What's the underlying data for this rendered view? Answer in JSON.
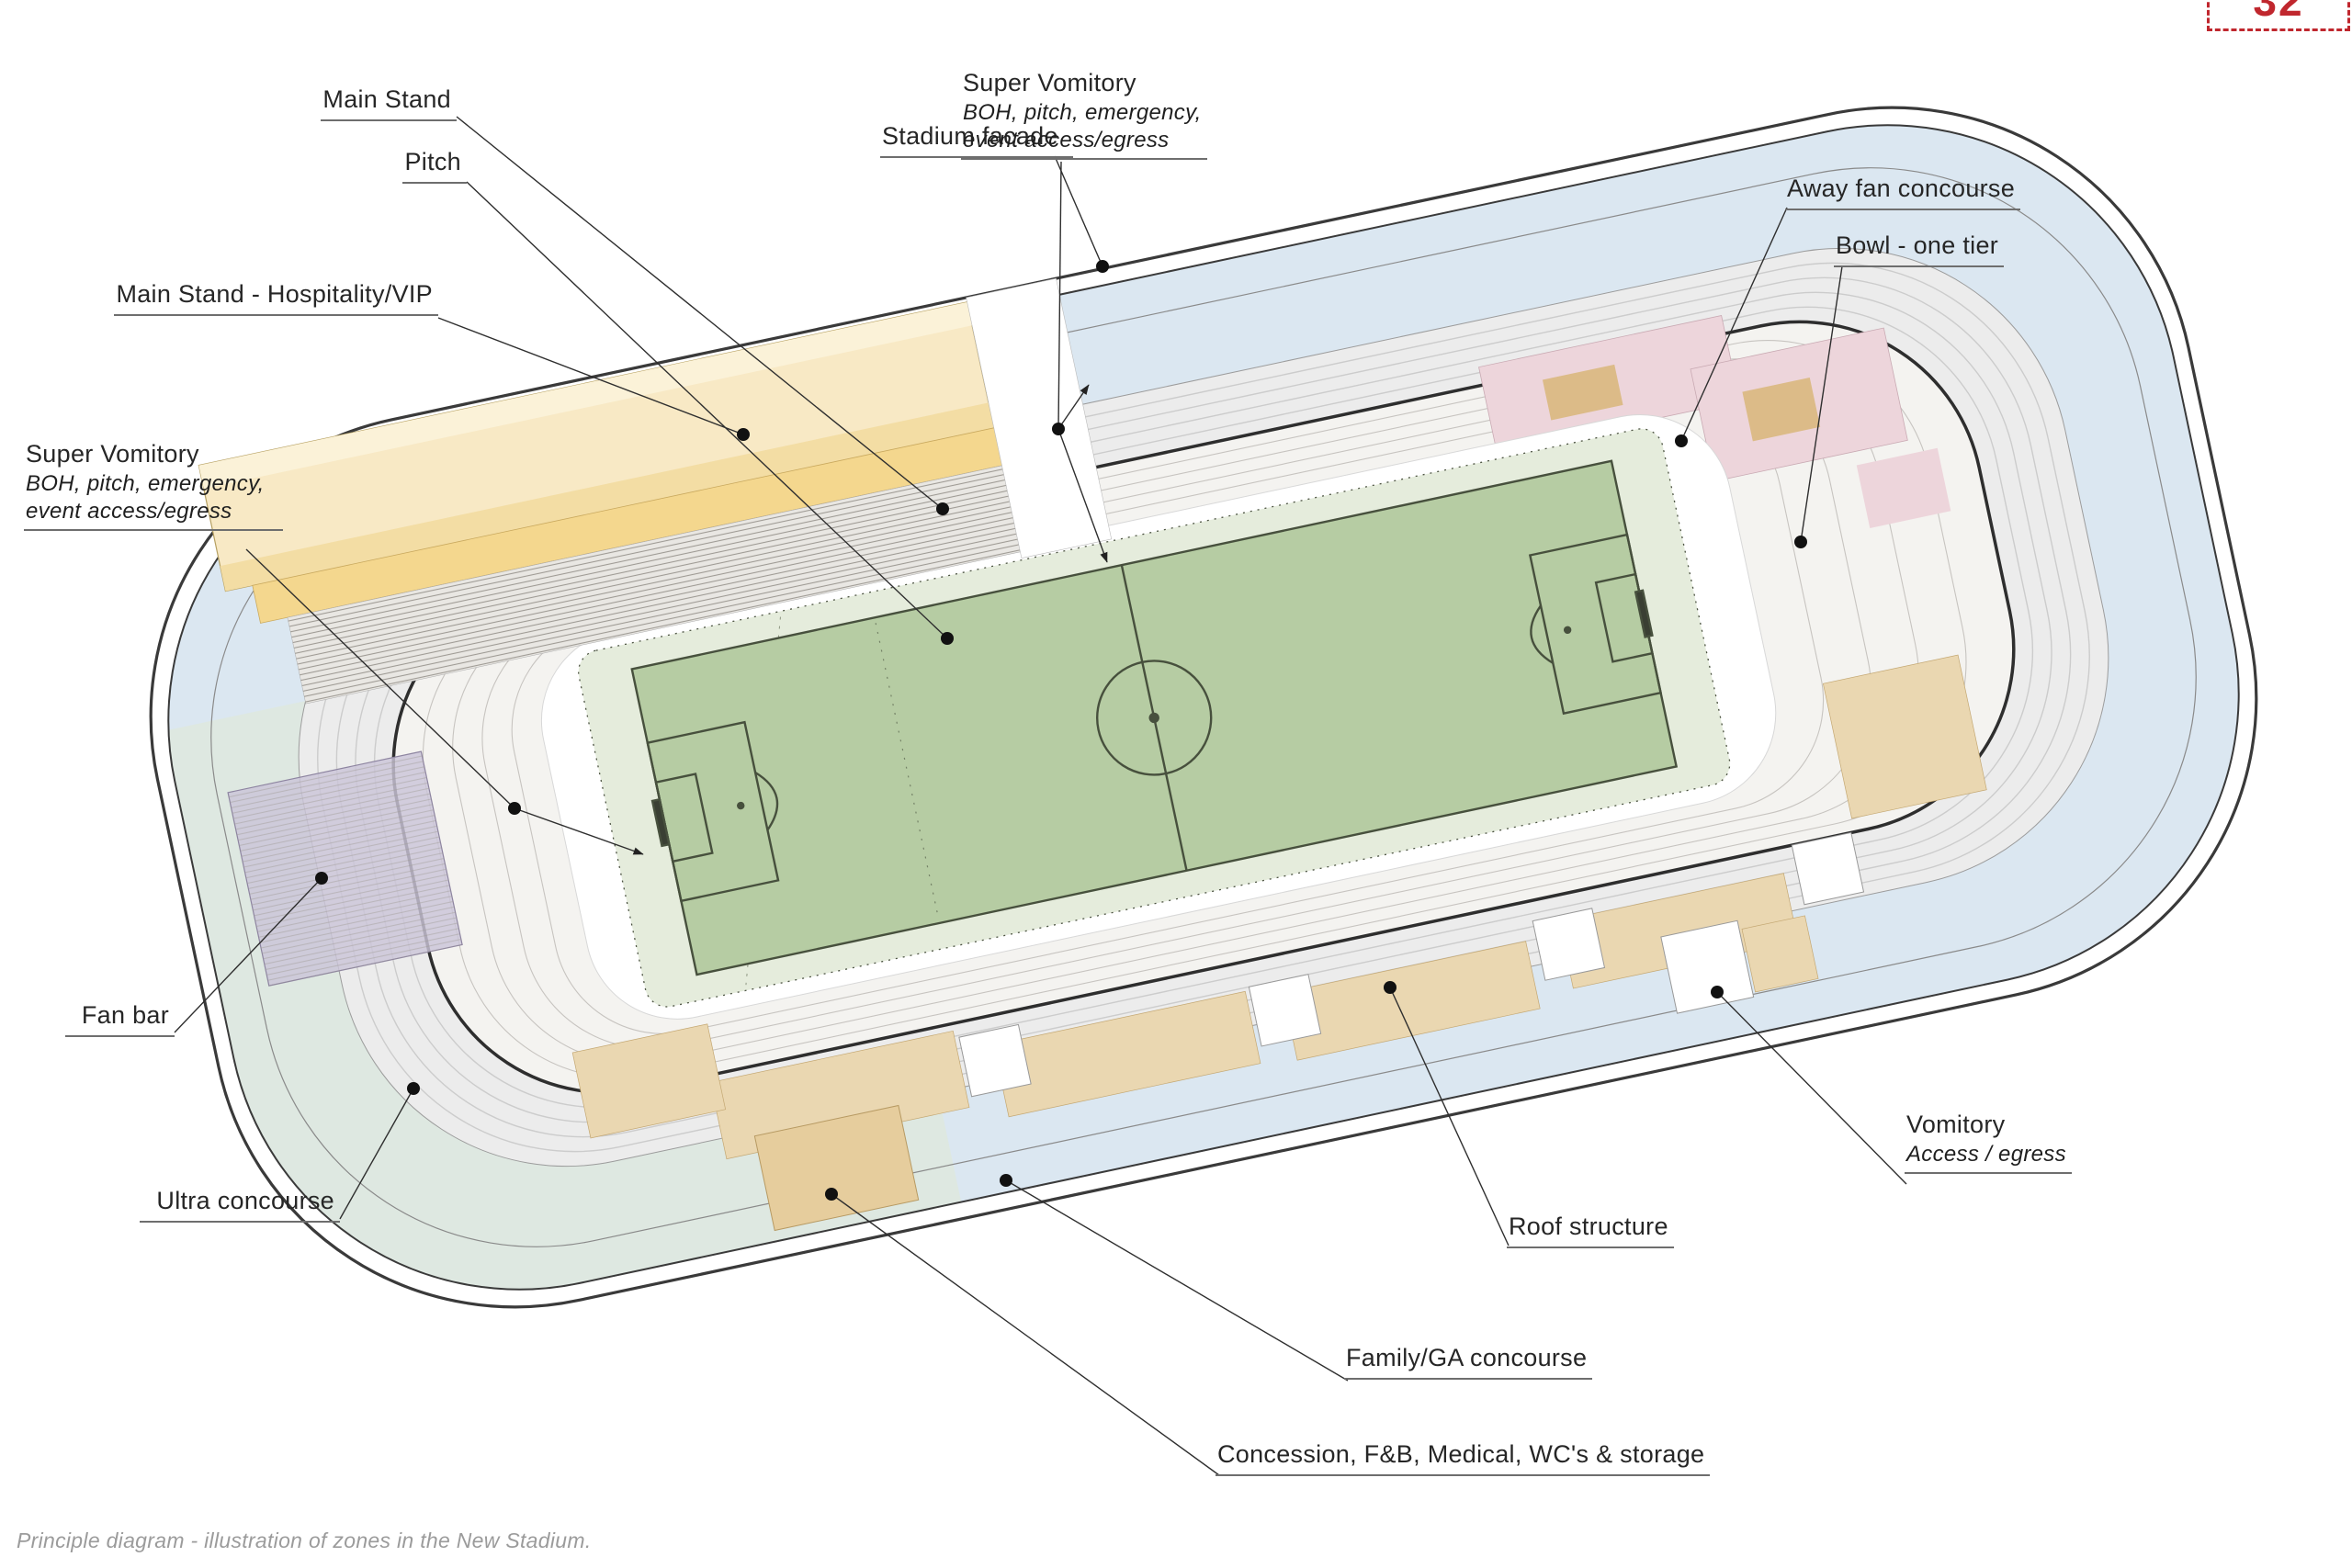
{
  "page": {
    "badge_number": "32",
    "caption": "Principle diagram - illustration of zones in the New Stadium."
  },
  "labels": {
    "main_stand": "Main Stand",
    "stadium_facade": "Stadium facade",
    "pitch": "Pitch",
    "main_stand_hospitality": "Main Stand - Hospitality/VIP",
    "super_vomitory_right": {
      "title": "Super Vomitory",
      "sub1": "BOH, pitch, emergency,",
      "sub2": "event access/egress"
    },
    "away_fan_concourse": "Away fan concourse",
    "bowl_one_tier": "Bowl - one tier",
    "super_vomitory_left": {
      "title": "Super Vomitory",
      "sub1": "BOH, pitch, emergency,",
      "sub2": "event access/egress"
    },
    "fan_bar": "Fan bar",
    "ultra_concourse": "Ultra concourse",
    "roof_structure": "Roof structure",
    "family_ga_concourse": "Family/GA concourse",
    "concession": "Concession, F&B, Medical, WC's & storage",
    "vomitory": {
      "title": "Vomitory",
      "sub": "Access / egress"
    }
  },
  "colors": {
    "facade_line": "#3a3a3a",
    "family_concourse_blue": "#dbe7f1",
    "ultra_concourse_teal": "#dee8e1",
    "roof_band": "#ececec",
    "seating_base": "#f4f3f0",
    "main_stand_yellow": "#f8e9c5",
    "hospitality_yellow": "#f4d78e",
    "terrace_tan": "#ead7b1",
    "away_pink": "#edd5db",
    "fan_bar_purple": "#cbc4d8",
    "pitch_green": "#b6cca3",
    "apron_green": "#e5ecdc",
    "pitch_line": "#47503d",
    "leader_line": "#2f2f2f",
    "badge_red": "#c0272e"
  }
}
